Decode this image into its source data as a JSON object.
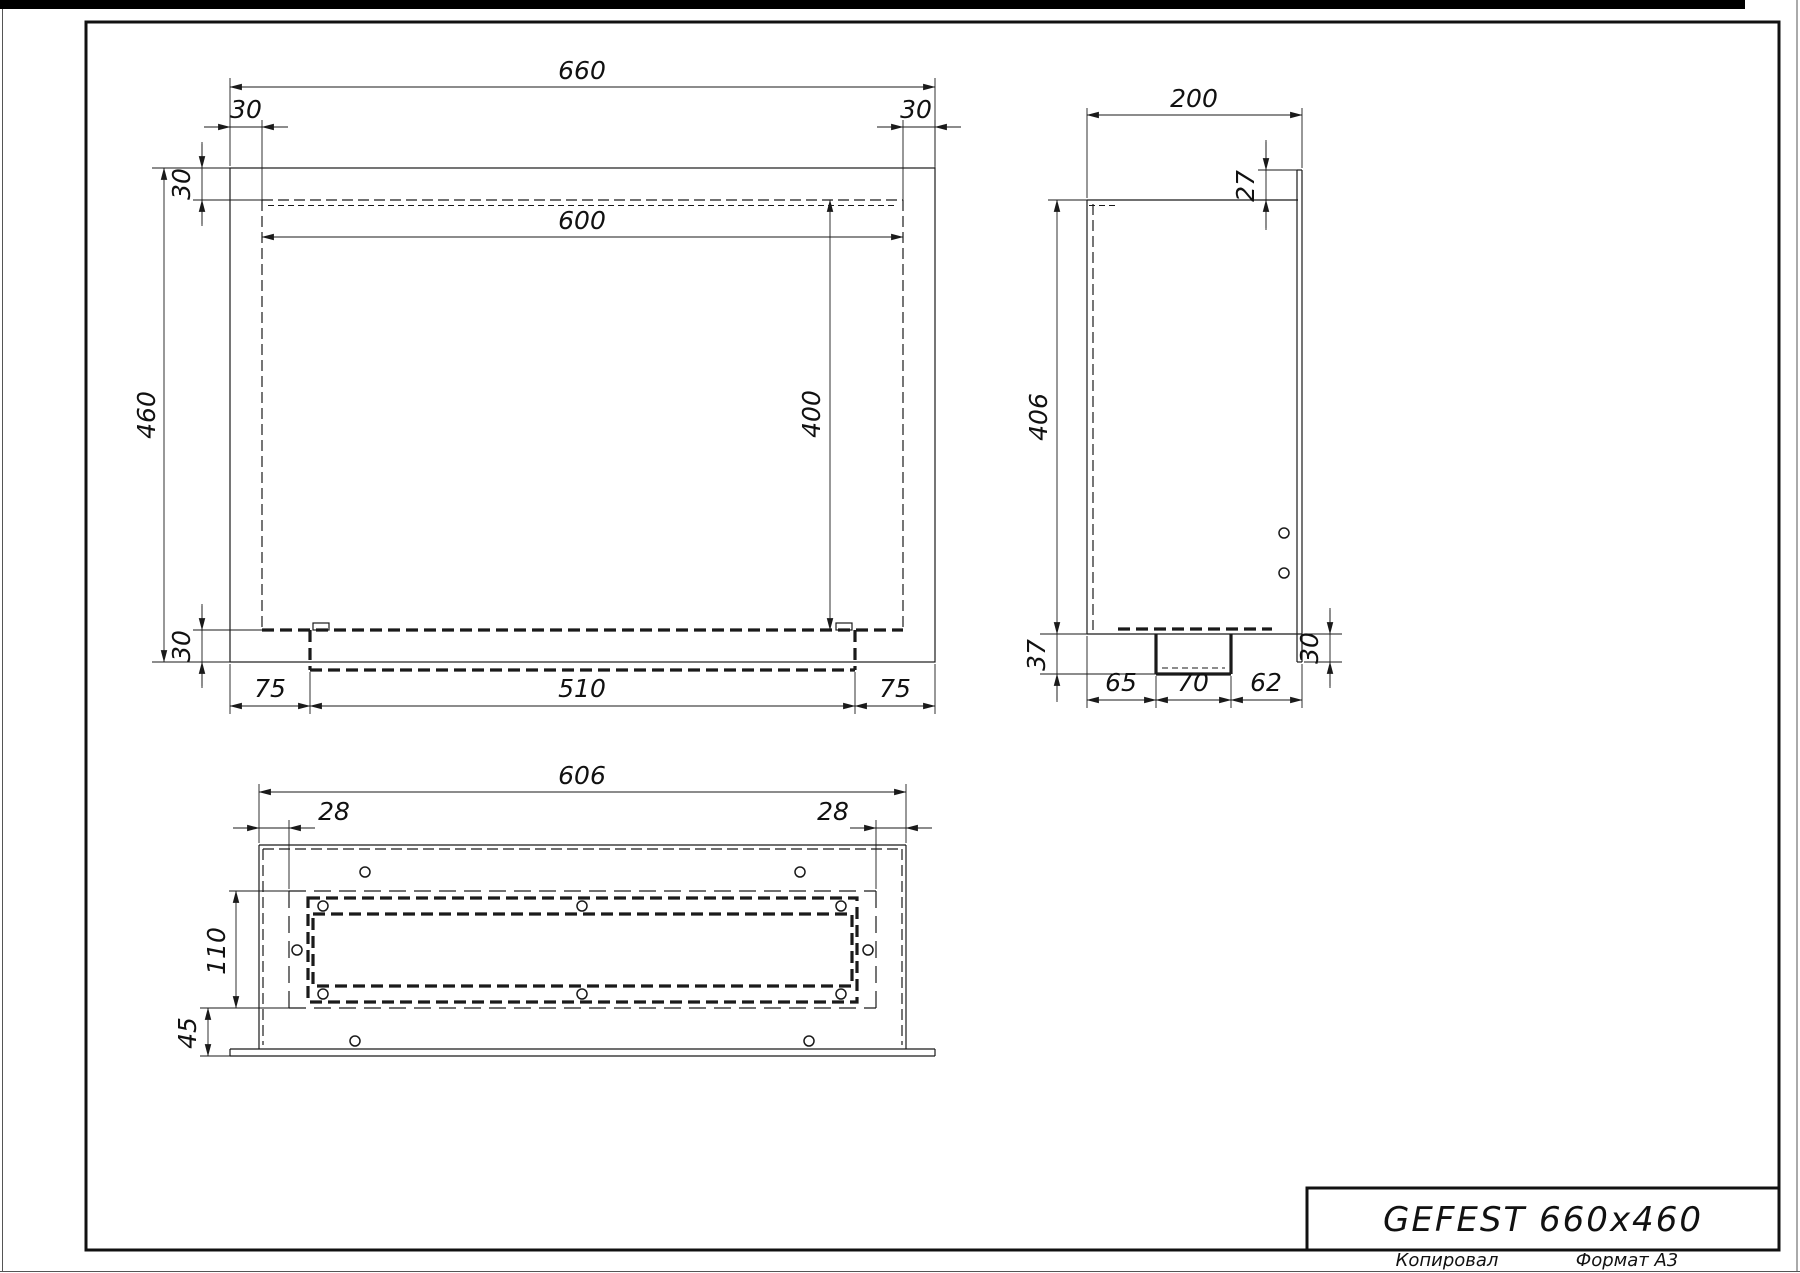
{
  "title_block": {
    "product": "GEFEST 660x460",
    "copied": "Копировал",
    "format": "Формат A3"
  },
  "dims": {
    "front": {
      "width": "660",
      "left_margin": "30",
      "right_margin": "30",
      "opening_width": "600",
      "height": "460",
      "top_border": "30",
      "opening_height": "400",
      "bottom_border": "30",
      "tray_left": "75",
      "tray_width": "510",
      "tray_right": "75"
    },
    "side": {
      "depth": "200",
      "flange_top": "27",
      "height": "406",
      "tray_drop": "37",
      "seg_left": "65",
      "seg_mid": "70",
      "seg_right": "62",
      "flange_bottom": "30"
    },
    "bottom": {
      "width": "606",
      "left_margin": "28",
      "right_margin": "28",
      "opening_depth": "110",
      "front_offset": "45"
    }
  }
}
